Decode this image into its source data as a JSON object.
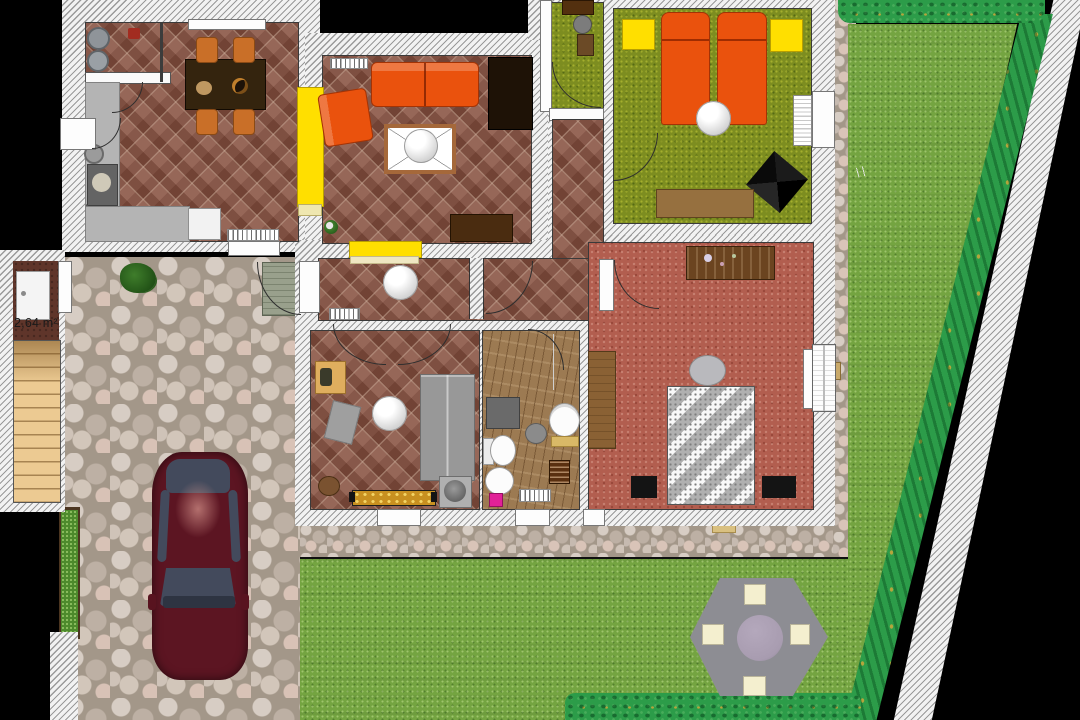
{
  "labels": {
    "utility_area": "2,64 m²"
  },
  "colors": {
    "wall_hatch_bg": "#f2f2f2",
    "wall_hatch_line": "#9a9a9a",
    "terracotta": "#8a5646",
    "olive_carpet": "#7d8d20",
    "red_carpet": "#b25e4f",
    "bathroom_wood": "#9c7a52",
    "lawn": "#74a441",
    "hedge": "#2c9c49",
    "hedge_dot": "#b5a53c",
    "stone_joint": "#a39789",
    "furniture_orange": "#ea520d",
    "accent_yellow": "#ffdf00",
    "counter_gray": "#b4b4b4",
    "wood_dark": "#34240e",
    "car_body": "#5c1522",
    "car_glass": "#434a5c",
    "patio_gray": "#8d8d93",
    "patio_table": "#a89cb0",
    "chair_cream": "#f4efcf",
    "bed_black": "#141414",
    "label_color": "#1a1a1a"
  }
}
